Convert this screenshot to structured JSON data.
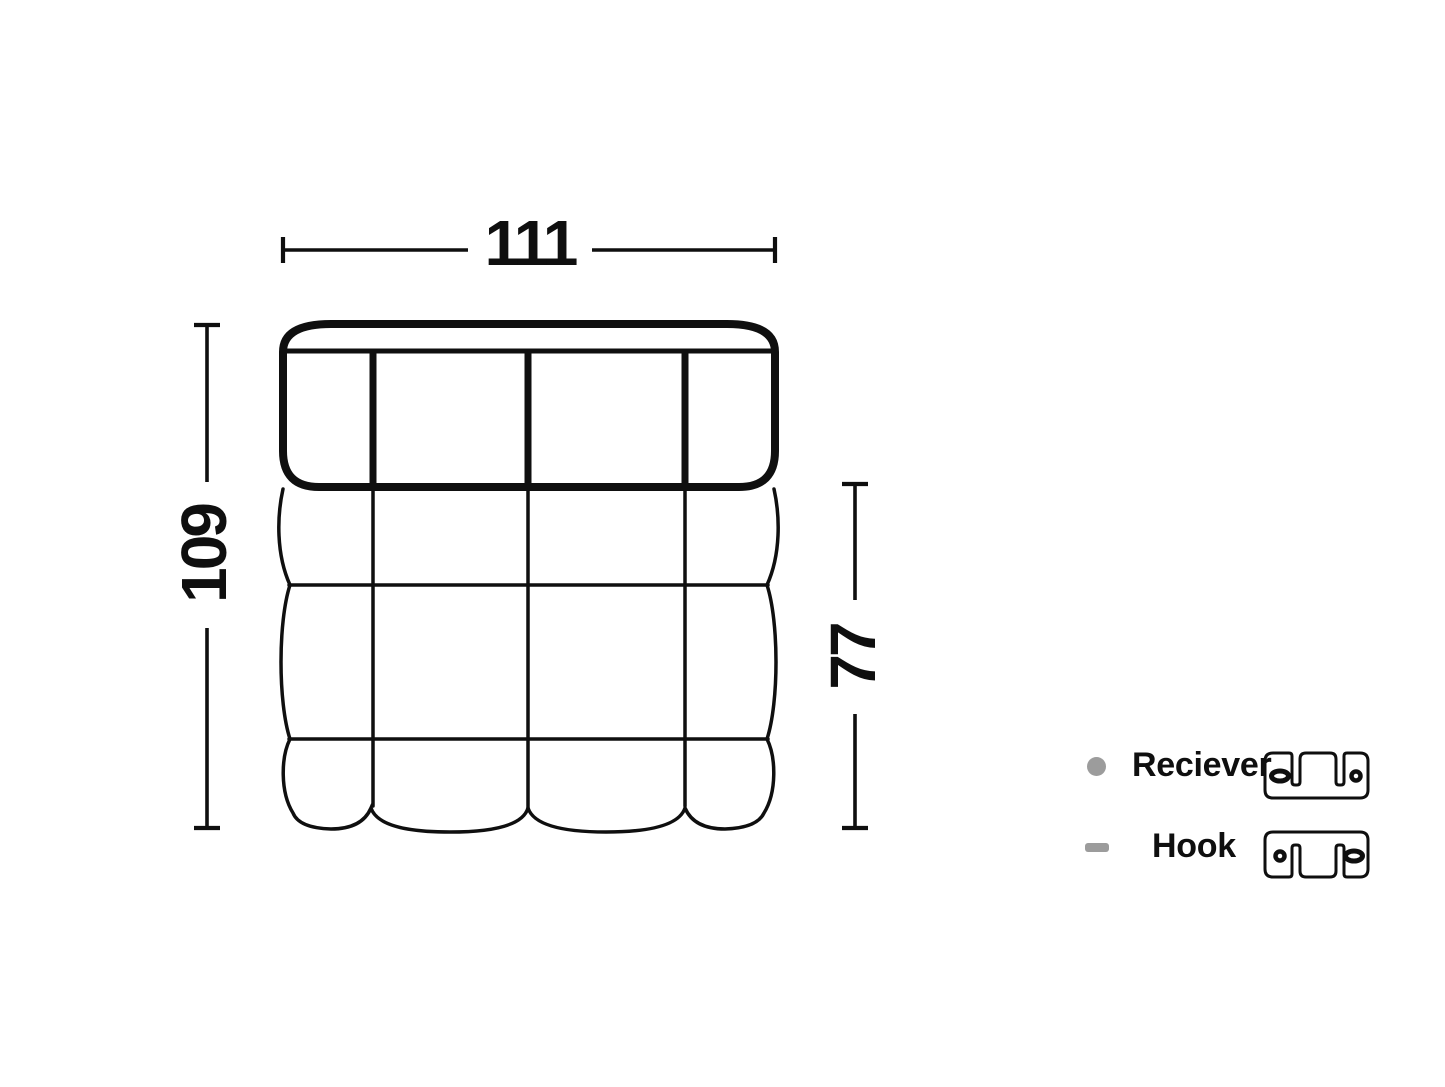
{
  "diagram": {
    "view": "top-view-of-quilted-modular-sofa-module",
    "ink_color": "#0f0f0f",
    "background_color": "#ffffff",
    "dimensions": {
      "width": "111",
      "depth": "109",
      "seat_depth": "77"
    },
    "legend": {
      "symbol_color": "#9c9c9c",
      "items": [
        {
          "symbol": "gray-circle",
          "label": "Reciever",
          "icon": "receiver-bracket-icon"
        },
        {
          "symbol": "gray-dash",
          "label": "Hook",
          "icon": "hook-bracket-icon"
        }
      ]
    }
  }
}
